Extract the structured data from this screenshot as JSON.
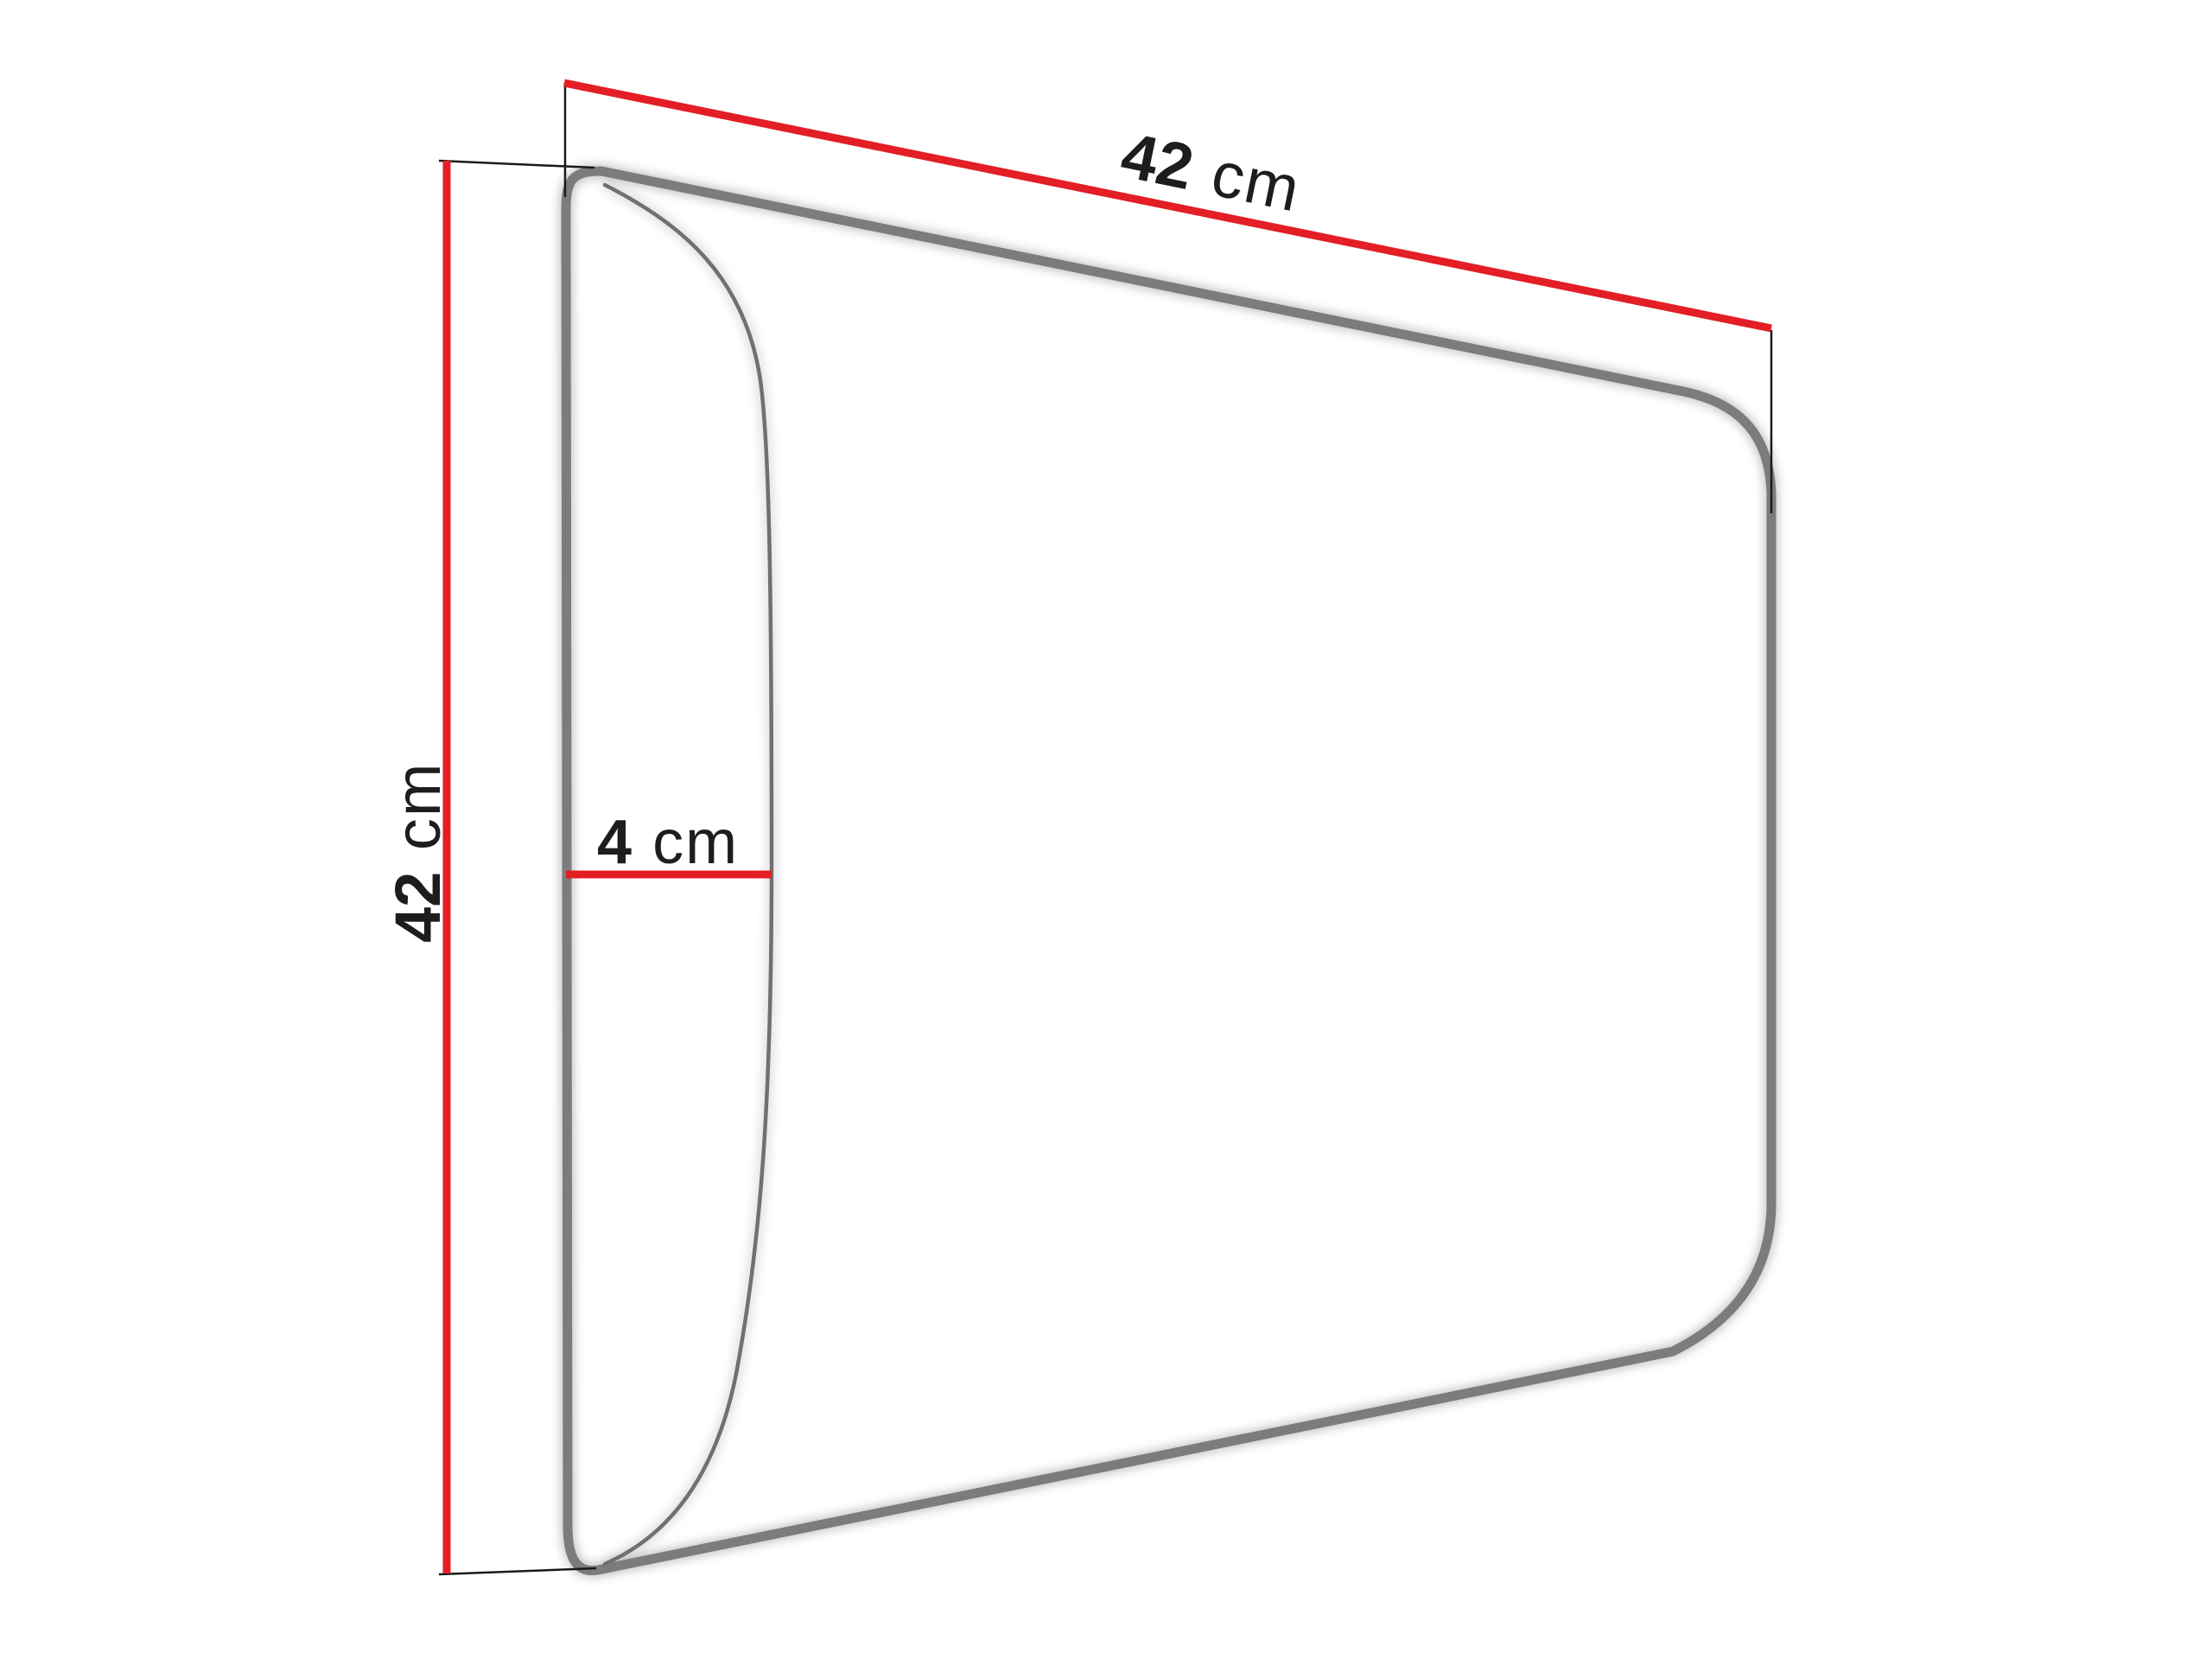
{
  "diagram": {
    "labels": {
      "width": {
        "value": "42",
        "unit": "cm"
      },
      "height": {
        "value": "42",
        "unit": "cm"
      },
      "depth": {
        "value": "4",
        "unit": "cm"
      }
    },
    "colors": {
      "dimension_line": "#e31e25",
      "extension_line": "#1a1a1a",
      "outline": "#7b7c7e",
      "front_edge_curve": "#6f7072",
      "label_text": "#1d1d1b",
      "background": "#ffffff"
    }
  }
}
